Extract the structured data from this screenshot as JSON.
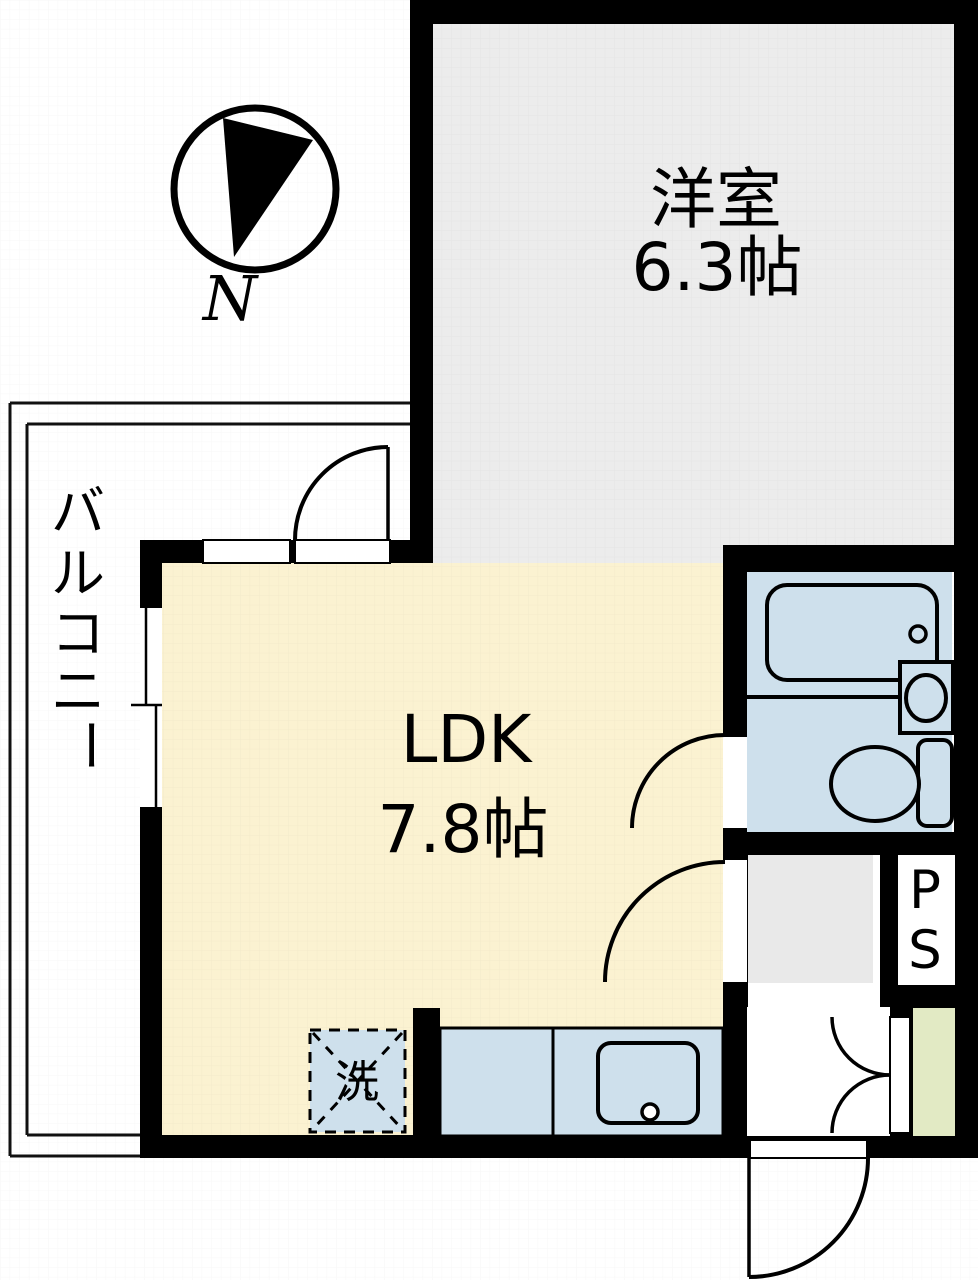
{
  "compass": {
    "north_label": "N"
  },
  "rooms": {
    "western": {
      "name": "洋室",
      "size": "6.3帖"
    },
    "ldk": {
      "name": "LDK",
      "size": "7.8帖"
    },
    "balcony": {
      "name": "バルコニー",
      "chars": [
        "バ",
        "ル",
        "コ",
        "ニ",
        "ー"
      ]
    },
    "pipe_space": {
      "line1": "P",
      "line2": "S"
    },
    "laundry": {
      "label": "洗"
    }
  },
  "colors": {
    "wall": "#000000",
    "western_floor": "#ececec",
    "ldk_floor": "#fbf2d1",
    "fixture_blue": "#cee0ec",
    "entrance_step_green": "#e2eac4",
    "closet_gray": "#e9e9e9",
    "line": "#111111"
  }
}
